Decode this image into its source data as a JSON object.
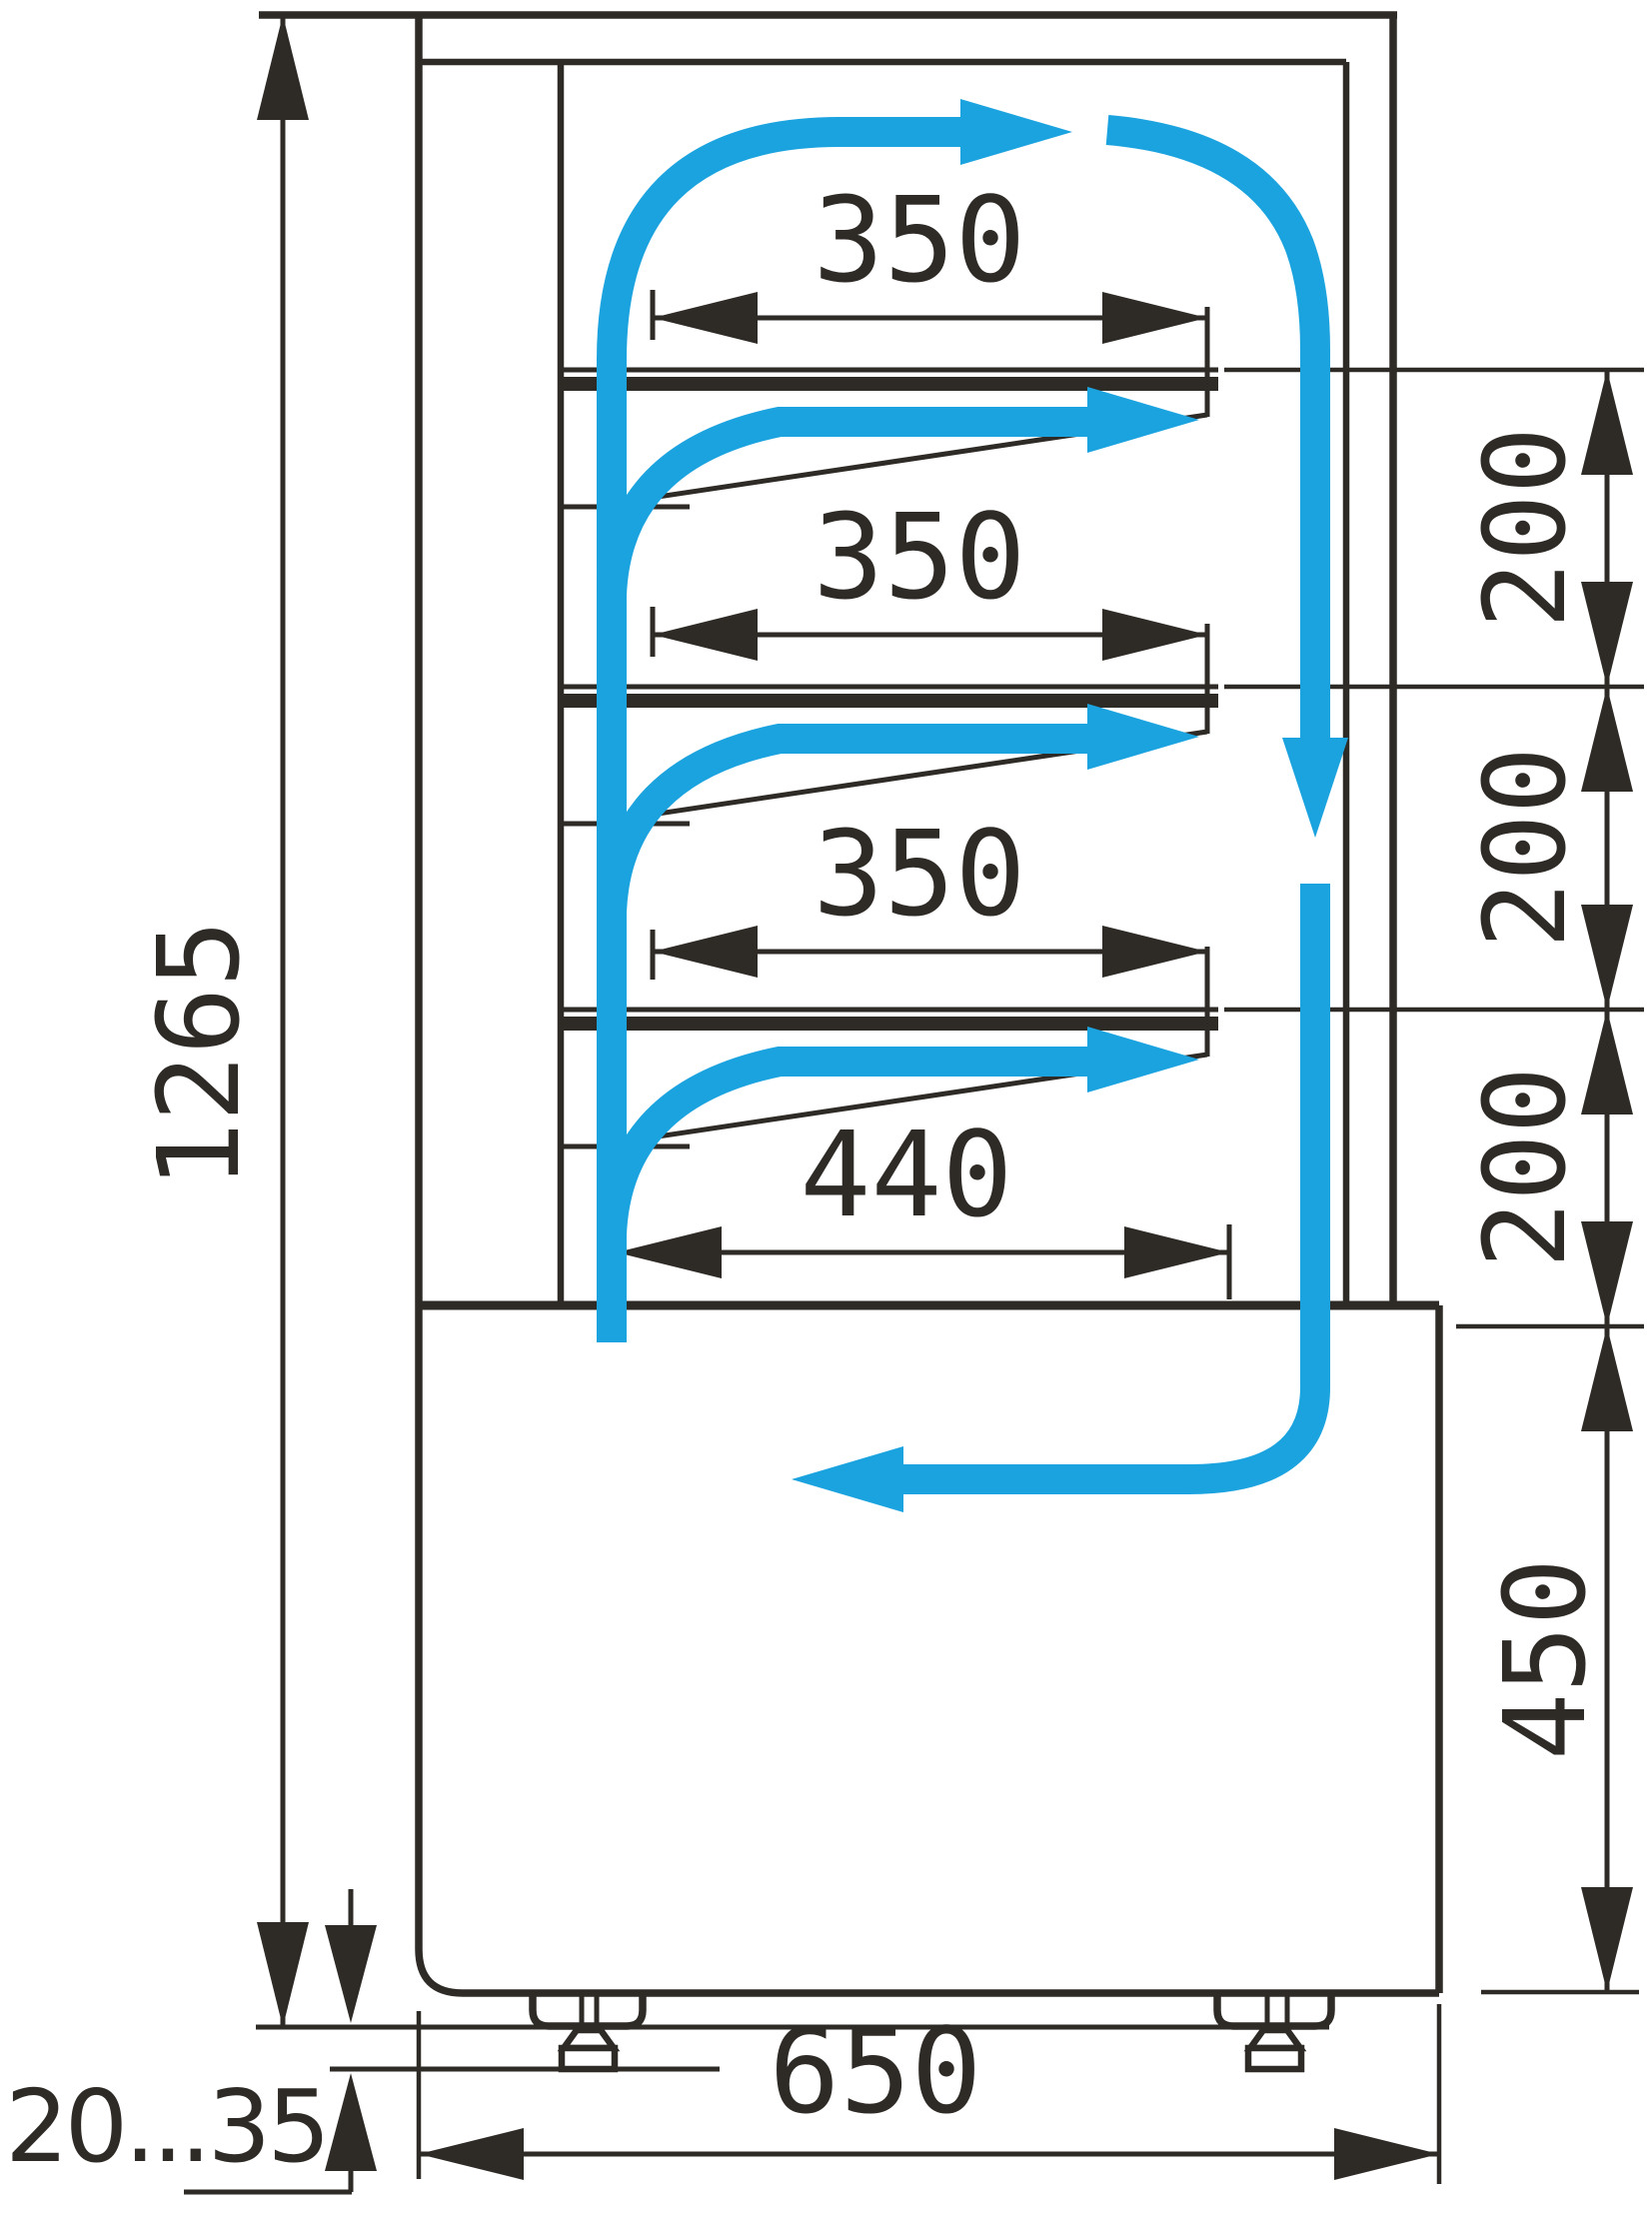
{
  "diagram": {
    "type": "technical-dimension-drawing",
    "subject": "refrigerated display case side section with air circulation loop",
    "units_shown": "mm",
    "labels": {
      "shelf_depth_1": "350",
      "shelf_depth_2": "350",
      "shelf_depth_3": "350",
      "bottom_shelf_depth": "440",
      "shelf_gap_1": "200",
      "shelf_gap_2": "200",
      "shelf_gap_3": "200",
      "base_section_height": "450",
      "overall_height": "1265",
      "overall_depth": "650",
      "foot_adjust_range": "20...35"
    },
    "colors": {
      "line": "#2e2a26",
      "airflow": "#1ba3df",
      "background": "#ffffff"
    }
  }
}
